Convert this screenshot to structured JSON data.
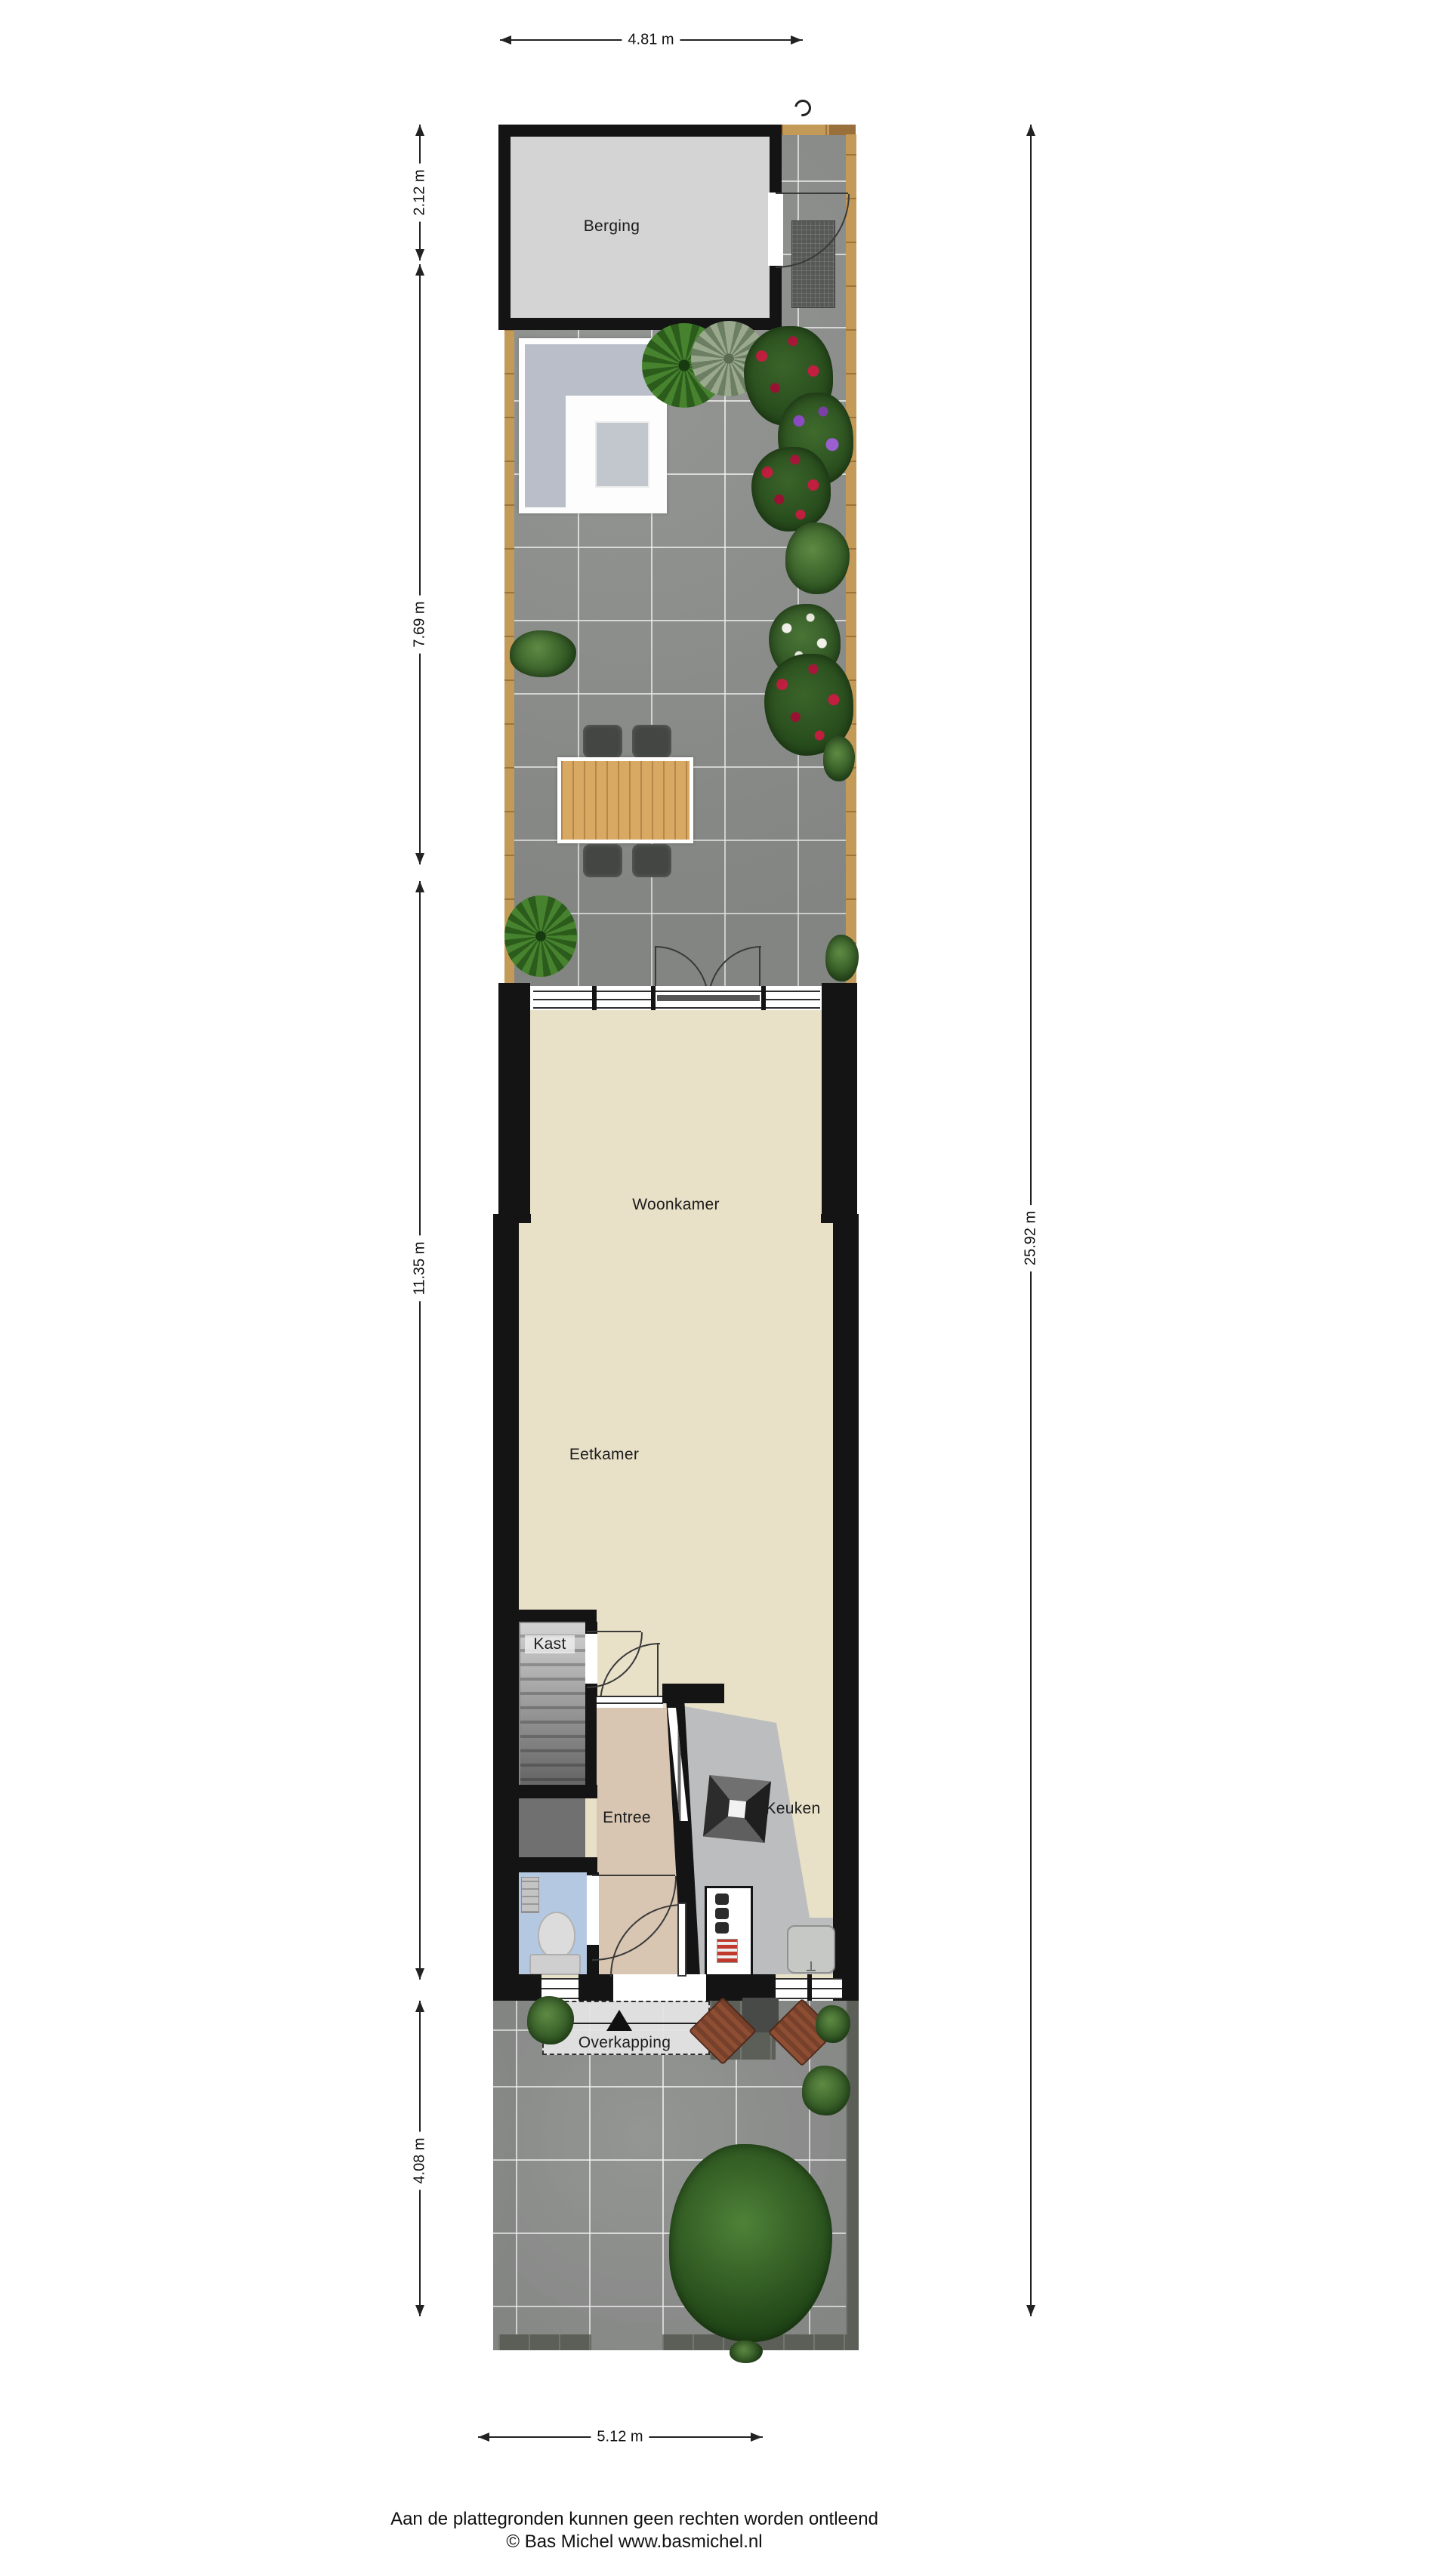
{
  "rooms": {
    "berging": "Berging",
    "woonkamer": "Woonkamer",
    "eetkamer": "Eetkamer",
    "kast": "Kast",
    "entree": "Entree",
    "keuken": "Keuken",
    "overkapping": "Overkapping"
  },
  "dimensions": {
    "top_width": "4.81 m",
    "berging_depth": "2.12 m",
    "back_garden_depth": "7.69 m",
    "house_depth": "11.35 m",
    "front_garden_depth": "4.08 m",
    "total_depth": "25.92 m",
    "bottom_width": "5.12 m"
  },
  "footer": {
    "line1": "Aan de plattegronden kunnen geen rechten worden ontleend",
    "line2": "© Bas Michel www.basmichel.nl"
  },
  "colors": {
    "wall": "#141414",
    "living_floor": "#e8e1c8",
    "entree_floor": "#d8c6b2",
    "toilet_floor": "#b5c8e2",
    "berging_floor": "#d4d4d4",
    "garden_tile": "#8e908e",
    "wood_edge": "#c49a58",
    "counter": "#bcbdbf"
  }
}
